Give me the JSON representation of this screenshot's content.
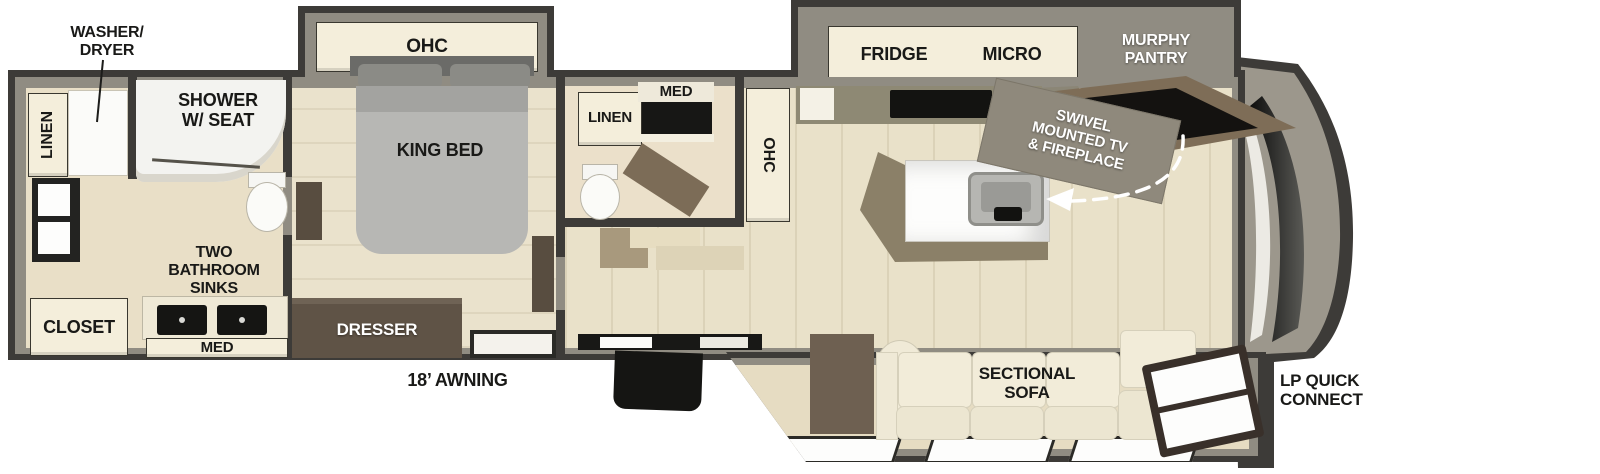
{
  "plan": {
    "rear_bath": {
      "washer_dryer": "WASHER/\nDRYER",
      "linen": "LINEN",
      "shower": "SHOWER\nW/ SEAT",
      "sinks": "TWO\nBATHROOM\nSINKS",
      "closet": "CLOSET",
      "med": "MED"
    },
    "bedroom": {
      "ohc": "OHC",
      "king_bed": "KING BED",
      "dresser": "DRESSER"
    },
    "half_bath": {
      "linen": "LINEN",
      "med": "MED"
    },
    "kitchen": {
      "fridge": "FRIDGE",
      "micro": "MICRO",
      "murphy_pantry": "MURPHY\nPANTRY",
      "ohc": "OHC",
      "swivel_tv": "SWIVEL\nMOUNTED TV\n& FIREPLACE"
    },
    "living": {
      "sectional_sofa": "SECTIONAL\nSOFA"
    },
    "exterior": {
      "awning": "18’ AWNING",
      "lp_quick_connect": "LP QUICK\nCONNECT"
    }
  },
  "colors": {
    "outline": "#3d3b38",
    "wall_gray": "#908c82",
    "floor_beige": "#e9e1c9",
    "cabinet_cream": "#f4eedb",
    "wood_brown": "#5f5346",
    "appliance_black": "#151513",
    "fireplace_glow": "#e8921c",
    "label_black": "#191917",
    "label_white": "#ffffff"
  }
}
